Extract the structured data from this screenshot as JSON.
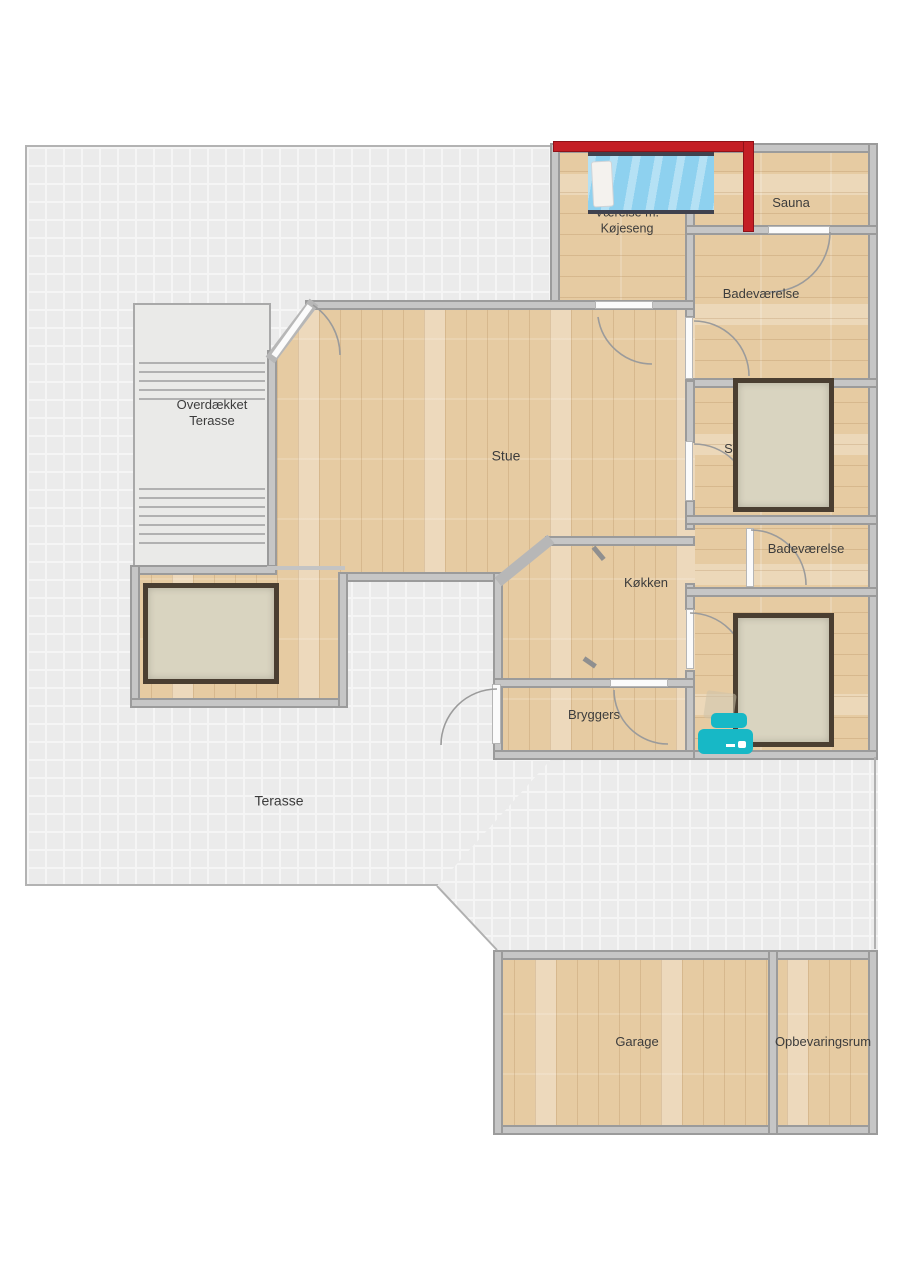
{
  "rooms": {
    "vaerelse_koejeseng": {
      "label_line1": "Værelse m.",
      "label_line2": "Køjeseng"
    },
    "sauna": {
      "label": "Sauna"
    },
    "badevaerelse_1": {
      "label": "Badeværelse"
    },
    "sovevaerelse_1": {
      "label": "Soveværelse"
    },
    "badevaerelse_2": {
      "label": "Badeværelse"
    },
    "stue": {
      "label": "Stue"
    },
    "koekken": {
      "label": "Køkken"
    },
    "bryggers": {
      "label": "Bryggers"
    },
    "overdaekket_terasse": {
      "label_line1": "Overdækket",
      "label_line2": "Terasse"
    },
    "terasse": {
      "label": "Terasse"
    },
    "garage": {
      "label": "Garage"
    },
    "opbevaringsrum": {
      "label": "Opbevaringsrum"
    }
  },
  "colors": {
    "wood": "#e6cba2",
    "wall": "#c6c6c6",
    "wall_edge": "#9b9b9b",
    "terrace_tile": "#ebebeb",
    "sauna_wall_red": "#c41e25",
    "furniture_teal": "#17b8c6",
    "bed_blue": "#8ed1ef",
    "bed_beige": "#d9d4c0",
    "bed_frame": "#4a3e31"
  }
}
